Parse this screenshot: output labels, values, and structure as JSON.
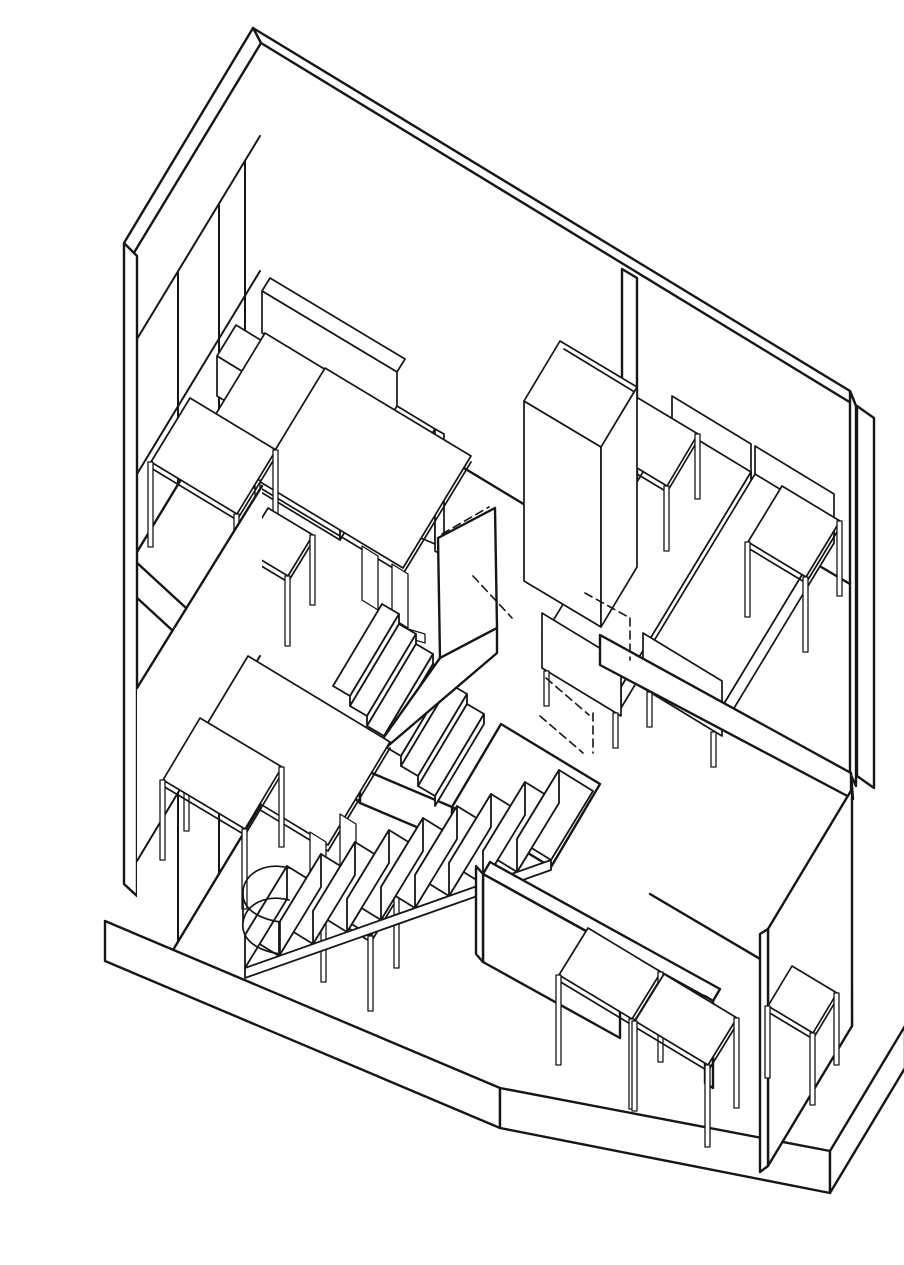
{
  "drawing": {
    "description": "Axonometric cutaway line drawing of a two-storey duplex dwelling: upper level with living room (sofa, square table, small table, stool, tall wardrobe) and bedroom with two single beds and two side tables; a dog-leg staircase with landing and dashed hidden edges links the levels; lower level living area with square table, small table and stool, and a lower-right room with two desks and a stool reached through a doorway; full-height glazed window walls with mullions on the left; thick floor slabs drawn in black ink on white paper.",
    "style": {
      "background": "#ffffff",
      "ink": "#161616"
    },
    "projection": "plan oblique (axonometric), verticals vertical",
    "levels": [
      {
        "name": "upper level",
        "rooms": [
          {
            "name": "living room",
            "furniture": [
              "sofa",
              "square table",
              "small table",
              "stool",
              "wardrobe"
            ]
          },
          {
            "name": "bedroom",
            "furniture": [
              "bed",
              "bed",
              "nightstand",
              "side table"
            ]
          }
        ]
      },
      {
        "name": "lower level",
        "rooms": [
          {
            "name": "living area",
            "furniture": [
              "square table",
              "small table",
              "stool"
            ]
          },
          {
            "name": "rear room",
            "furniture": [
              "desk",
              "desk",
              "stool"
            ]
          }
        ]
      }
    ],
    "stairs": {
      "upper_flight_steps": 6,
      "lower_flight_steps": 9,
      "landing": 1,
      "hidden_edges_style": "dashed",
      "bottom_step": "curved bullnose"
    },
    "windows": {
      "upper_wall_mullions": 3,
      "lower_wall_mullions": 3
    },
    "doors": 1
  }
}
